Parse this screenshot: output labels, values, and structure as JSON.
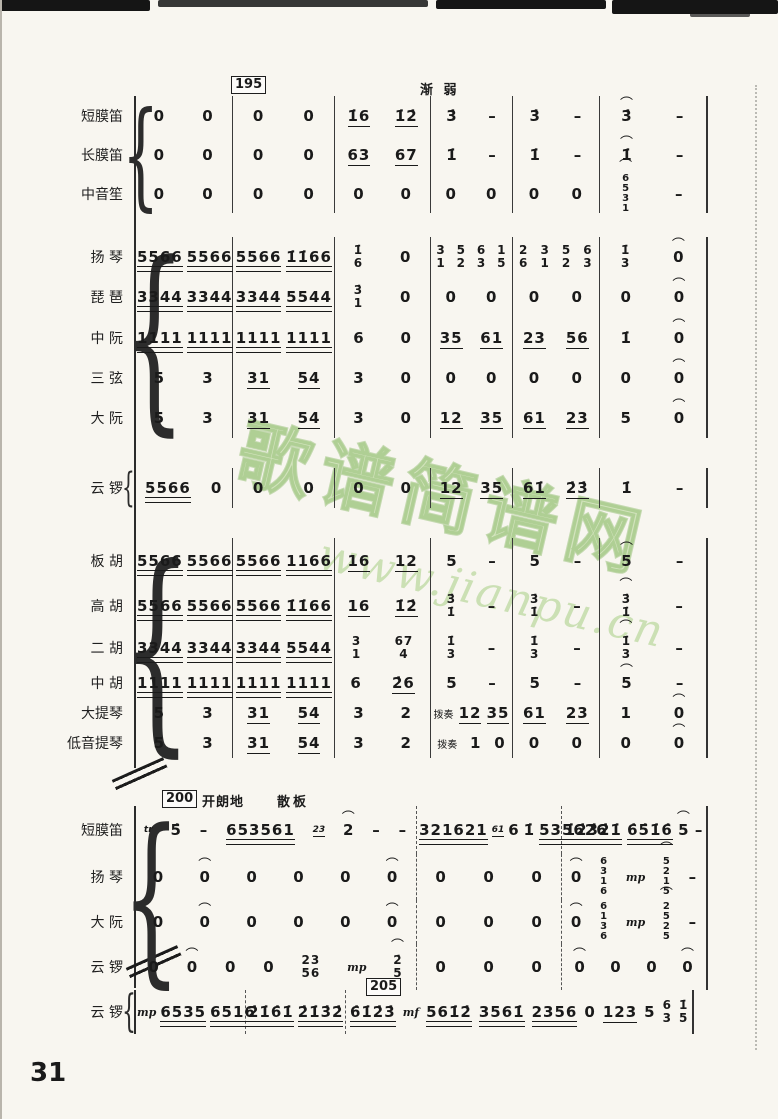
{
  "page": {
    "number": "31"
  },
  "watermark": {
    "line1": "歌谱简谱网",
    "line2": "www.jianpu.cn",
    "color": "#9ec978"
  },
  "annotations": {
    "rehearsal_195": "195",
    "rehearsal_200": "200",
    "rehearsal_205": "205",
    "decrescendo": "渐 弱",
    "mood": "开朗地",
    "tempo_free": "散板"
  },
  "systems": [
    {
      "id": "system-1",
      "groups": [
        {
          "rows": [
            {
              "label": "短膜笛",
              "cells": [
                [
                  "0",
                  "0"
                ],
                [
                  "0",
                  "0"
                ],
                [
                  "1̇6",
                  "1̇2̇"
                ],
                [
                  "3̇",
                  "-"
                ],
                [
                  "3̇",
                  "-"
                ],
                [
                  "^3̇",
                  "-"
                ]
              ]
            },
            {
              "label": "长膜笛",
              "cells": [
                [
                  "0",
                  "0"
                ],
                [
                  "0",
                  "0"
                ],
                [
                  "63",
                  "67"
                ],
                [
                  "1̇",
                  "-"
                ],
                [
                  "1̇",
                  "-"
                ],
                [
                  "^1̇",
                  "-"
                ]
              ]
            },
            {
              "label": "中音笙",
              "cells": [
                [
                  "0",
                  "0"
                ],
                [
                  "0",
                  "0"
                ],
                [
                  "0",
                  "0"
                ],
                [
                  "0",
                  "0"
                ],
                [
                  "0",
                  "0"
                ],
                [
                  "^6/5/3/1",
                  "-"
                ]
              ]
            }
          ]
        },
        {
          "rows": [
            {
              "label": "扬 琴",
              "cells": [
                [
                  "5566",
                  "5566"
                ],
                [
                  "5566",
                  "1̇1̇66"
                ],
                [
                  "1̇/6",
                  "0"
                ],
                [
                  "3/1",
                  "5/2",
                  "6/3",
                  "1/5"
                ],
                [
                  "2/6",
                  "3/1",
                  "5/2",
                  "6/3"
                ],
                [
                  "1̇/3",
                  "^0"
                ]
              ]
            },
            {
              "label": "琵 琶",
              "cells": [
                [
                  "3344",
                  "3344"
                ],
                [
                  "3344",
                  "5544"
                ],
                [
                  "3̇/1",
                  "0"
                ],
                [
                  "0",
                  "0"
                ],
                [
                  "0",
                  "0"
                ],
                [
                  "0",
                  "^0"
                ]
              ]
            },
            {
              "label": "中 阮",
              "cells": [
                [
                  "1111",
                  "1111"
                ],
                [
                  "1111",
                  "1111"
                ],
                [
                  "6",
                  "0"
                ],
                [
                  "35",
                  "61"
                ],
                [
                  "23",
                  "56"
                ],
                [
                  "1̇",
                  "^0"
                ]
              ]
            },
            {
              "label": "三 弦",
              "cells": [
                [
                  "5",
                  "3"
                ],
                [
                  "31",
                  "54"
                ],
                [
                  "3",
                  "0"
                ],
                [
                  "0",
                  "0"
                ],
                [
                  "0",
                  "0"
                ],
                [
                  "0",
                  "^0"
                ]
              ]
            },
            {
              "label": "大 阮",
              "cells": [
                [
                  "5",
                  "3"
                ],
                [
                  "31",
                  "54"
                ],
                [
                  "3",
                  "0"
                ],
                [
                  "12",
                  "35"
                ],
                [
                  "61",
                  "23"
                ],
                [
                  "5",
                  "^0"
                ]
              ]
            }
          ]
        },
        {
          "rows": [
            {
              "label": "云 锣",
              "cells": [
                [
                  "5566",
                  "0"
                ],
                [
                  "0",
                  "0"
                ],
                [
                  "0",
                  "0"
                ],
                [
                  "12",
                  "35"
                ],
                [
                  "61̇",
                  "2̇3̇"
                ],
                [
                  "1̇",
                  "-"
                ]
              ]
            }
          ]
        },
        {
          "rows": [
            {
              "label": "板 胡",
              "cells": [
                [
                  "5566",
                  "5566"
                ],
                [
                  "5566",
                  "1166"
                ],
                [
                  "16",
                  "12"
                ],
                [
                  "5",
                  "-"
                ],
                [
                  "5",
                  "-"
                ],
                [
                  "^5",
                  "-"
                ]
              ]
            },
            {
              "label": "高 胡",
              "cells": [
                [
                  "5566",
                  "5566"
                ],
                [
                  "5566",
                  "1̇1̇66"
                ],
                [
                  "16",
                  "1̇2̇"
                ],
                [
                  "3̇/1̇",
                  "-"
                ],
                [
                  "3̇/1̇",
                  "-"
                ],
                [
                  "^3̇/1̇",
                  "-"
                ]
              ]
            },
            {
              "label": "二 胡",
              "cells": [
                [
                  "3344",
                  "3344"
                ],
                [
                  "3344",
                  "5544"
                ],
                [
                  "3/1",
                  "67/4"
                ],
                [
                  "1̇/3",
                  "-"
                ],
                [
                  "1̇/3",
                  "-"
                ],
                [
                  "^1̇/3",
                  "-"
                ]
              ]
            },
            {
              "label": "中 胡",
              "cells": [
                [
                  "1111",
                  "1111"
                ],
                [
                  "1111",
                  "1111"
                ],
                [
                  "6",
                  "2̇6"
                ],
                [
                  "5",
                  "-"
                ],
                [
                  "5",
                  "-"
                ],
                [
                  "^5",
                  "-"
                ]
              ]
            },
            {
              "label": "大提琴",
              "cells": [
                [
                  "5",
                  "3"
                ],
                [
                  "31",
                  "54"
                ],
                [
                  "3",
                  "2"
                ],
                [
                  "@拨奏",
                  "12",
                  "35"
                ],
                [
                  "61",
                  "23"
                ],
                [
                  "1",
                  "^0"
                ]
              ]
            },
            {
              "label": "低音提琴",
              "cells": [
                [
                  "5",
                  "3"
                ],
                [
                  "31",
                  "54"
                ],
                [
                  "3",
                  "2"
                ],
                [
                  "@拨奏",
                  "1",
                  "0"
                ],
                [
                  "0",
                  "0"
                ],
                [
                  "0",
                  "^0"
                ]
              ]
            }
          ]
        }
      ]
    },
    {
      "id": "system-2",
      "groups": [
        {
          "rows": [
            {
              "label": "短膜笛",
              "cells": [
                [
                  "`tr",
                  "5̇",
                  "-",
                  "653561",
                  "`23",
                  "^2",
                  "-",
                  "-"
                ],
                [
                  "321621",
                  "`61",
                  "6",
                  "1̇",
                  "535626"
                ],
                [
                  "1̇2̇3̇2̇1̇",
                  "6̇5̇1̇6̇",
                  "^5",
                  "-"
                ]
              ]
            },
            {
              "label": "扬 琴",
              "cells": [
                [
                  "0",
                  "^0",
                  "0",
                  "0",
                  "0",
                  "^0"
                ],
                [
                  "0",
                  "0",
                  "0"
                ],
                [
                  "^0",
                  "6/3/1/6",
                  "$mp",
                  "^5/2/1/5",
                  "-"
                ]
              ]
            },
            {
              "label": "大 阮",
              "cells": [
                [
                  "0",
                  "^0",
                  "0",
                  "0",
                  "0",
                  "^0"
                ],
                [
                  "0",
                  "0",
                  "0"
                ],
                [
                  "^0",
                  "6/1/3/6",
                  "$mp",
                  "^2/5/2/5",
                  "-"
                ]
              ]
            },
            {
              "label": "云 锣",
              "cells": [
                [
                  "0",
                  "^0",
                  "0",
                  "0",
                  "23/56",
                  "$mp",
                  "^2̇/5"
                ],
                [
                  "0",
                  "0",
                  "0"
                ],
                [
                  "^0",
                  "0",
                  "0",
                  "^0"
                ]
              ]
            }
          ]
        }
      ]
    },
    {
      "id": "coda",
      "groups": [
        {
          "rows": [
            {
              "label": "云 锣",
              "cells": [
                [
                  "$mp",
                  "6535",
                  "6516"
                ],
                [
                  "2̇1̇6̇1̇",
                  "2̇1̇3̇2̇"
                ],
                [
                  "6̇1̇2̇3̇",
                  "$mf",
                  "561̇2̇",
                  "3561̇",
                  "2356",
                  "0",
                  "123",
                  "5",
                  "6/3",
                  "1̇/5"
                ]
              ]
            }
          ]
        }
      ]
    }
  ]
}
